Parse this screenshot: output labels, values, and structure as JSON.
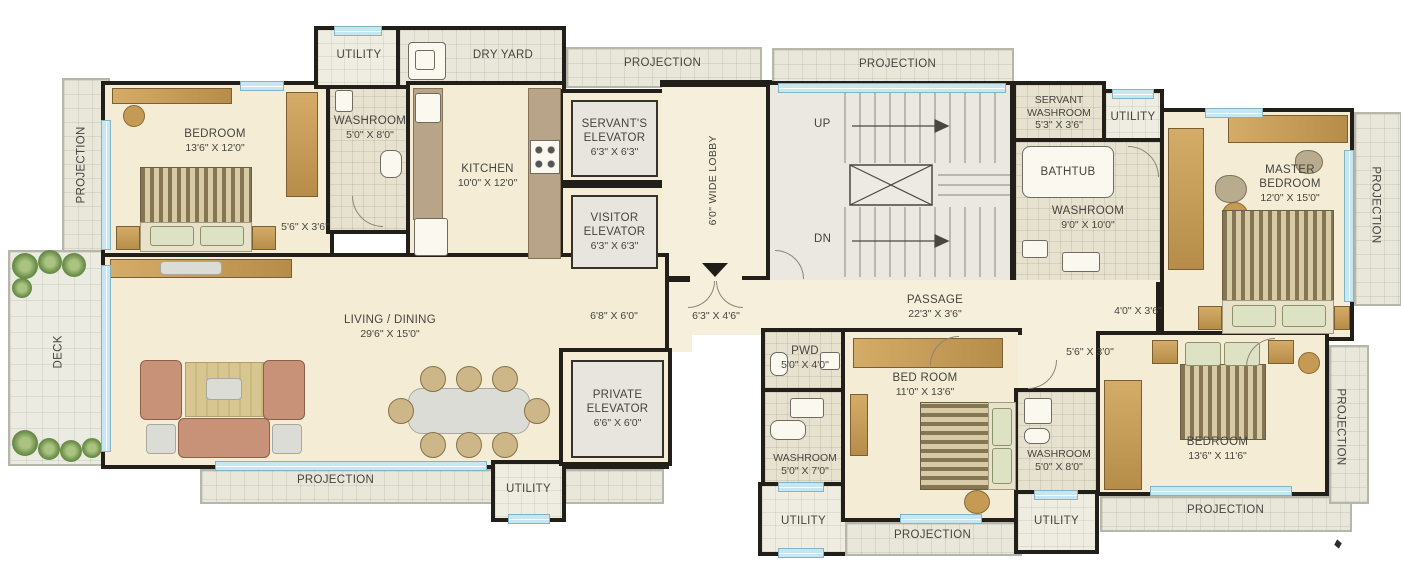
{
  "labels": {
    "projection": "PROJECTION",
    "deck": "DECK",
    "utility": "UTILITY",
    "dry_yard": "DRY YARD",
    "up": "UP",
    "dn": "DN",
    "bathtub": "BATHTUB",
    "lobby": "6'0\" WIDE LOBBY",
    "passage": {
      "name": "PASSAGE",
      "dims": "22'3\" X 3'6\""
    },
    "bedroom1": {
      "name": "BEDROOM",
      "dims": "13'6\" X 12'0\""
    },
    "washroom1": {
      "name": "WASHROOM",
      "dims": "5'0\" X 8'0\""
    },
    "kitchen": {
      "name": "KITCHEN",
      "dims": "10'0\" X 12'0\""
    },
    "servants_elevator": {
      "l1": "SERVANT'S",
      "l2": "ELEVATOR",
      "dims": "6'3\" X 6'3\""
    },
    "visitor_elevator": {
      "l1": "VISITOR",
      "l2": "ELEVATOR",
      "dims": "6'3\" X 6'3\""
    },
    "private_elevator": {
      "l1": "PRIVATE",
      "l2": "ELEVATOR",
      "dims": "6'6\" X 6'0\""
    },
    "servant_washroom": {
      "l1": "SERVANT",
      "l2": "WASHROOM",
      "dims": "5'3\" X 3'6\""
    },
    "washroom_master": {
      "name": "WASHROOM",
      "dims": "9'0\" X 10'0\""
    },
    "master_bedroom": {
      "l1": "MASTER",
      "l2": "BEDROOM",
      "dims": "12'0\" X 15'0\""
    },
    "living_dining": {
      "name": "LIVING / DINING",
      "dims": "29'6\" X 15'0\""
    },
    "pwd": {
      "name": "PWD",
      "dims": "5'0\" X 4'0\""
    },
    "washroom_b1": {
      "name": "WASHROOM",
      "dims": "5'0\" X 7'0\""
    },
    "bedroom2": {
      "name": "BED ROOM",
      "dims": "11'0\" X 13'6\""
    },
    "washroom_b2": {
      "name": "WASHROOM",
      "dims": "5'0\" X 8'0\""
    },
    "bedroom3": {
      "name": "BEDROOM",
      "dims": "13'6\" X 11'6\""
    },
    "dim_bed1_lobby": "5'6\" X 3'6\"",
    "dim_foyer": "6'8\" X 6'0\"",
    "dim_entry": "6'3\" X 4'6\"",
    "dim_passage_r": "4'0\" X 3'6\"",
    "dim_corridor_b": "5'6\" X 3'0\""
  },
  "colors": {
    "wall": "#221f1b",
    "floor_cream": "#f4ecd5",
    "tile": "#e9e7da",
    "window_blue": "#c6e6f1",
    "wood": "#c49a56",
    "label_text": "#45443e"
  }
}
